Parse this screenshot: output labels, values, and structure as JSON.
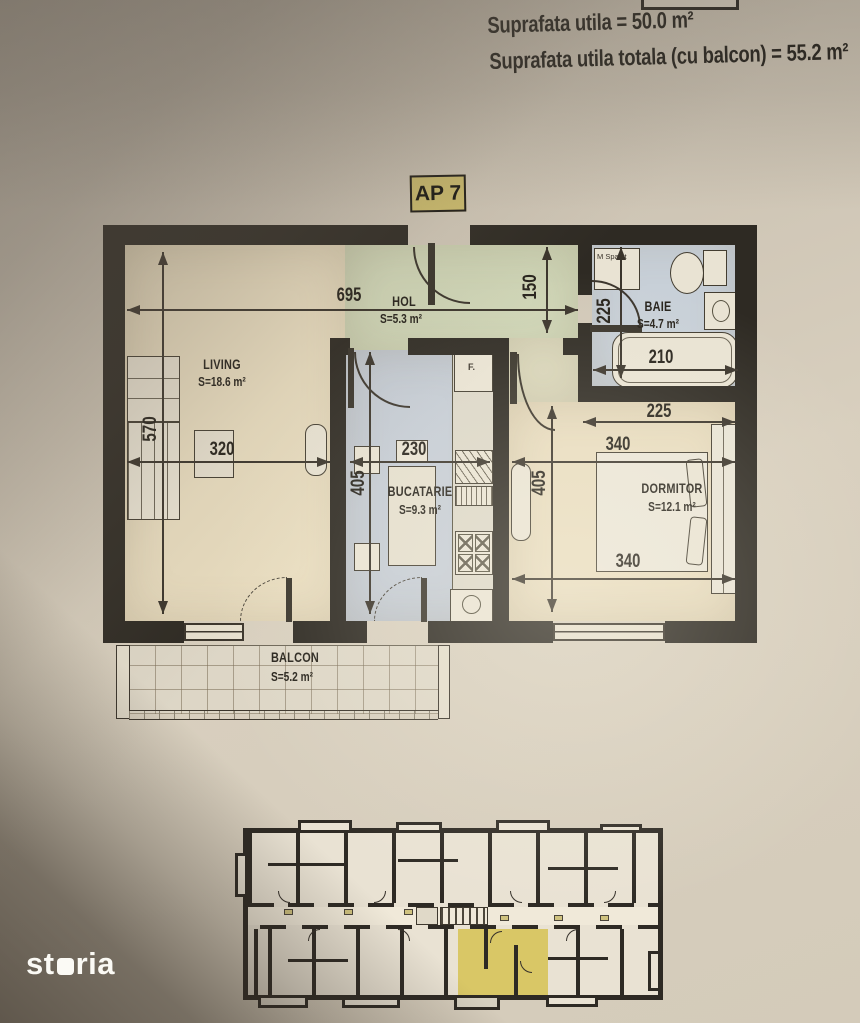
{
  "header": {
    "line1": "Suprafata utila = 50.0 m²",
    "line2": "Suprafata utila totala (cu balcon) = 55.2 m²"
  },
  "apartment": {
    "label": "AP 7"
  },
  "rooms": {
    "living": {
      "name": "LIVING",
      "area": "S=18.6 m²"
    },
    "hol": {
      "name": "HOL",
      "area": "S=5.3 m²"
    },
    "baie": {
      "name": "BAIE",
      "area": "S=4.7 m²"
    },
    "bucatarie": {
      "name": "BUCATARIE",
      "area": "S=9.3 m²"
    },
    "dormitor": {
      "name": "DORMITOR",
      "area": "S=12.1 m²"
    },
    "balcon": {
      "name": "BALCON",
      "area": "S=5.2 m²"
    }
  },
  "fixtures": {
    "washing_machine": "M Spalat",
    "fridge": "F."
  },
  "dimensions": {
    "hol_width": "695",
    "hol_depth": "150",
    "living_width": "320",
    "living_height": "570",
    "kitchen_width": "230",
    "kitchen_height": "405",
    "baie_depth": "225",
    "bathtub_width": "210",
    "dormitor_upper_width": "225",
    "dormitor_width_top": "340",
    "dormitor_height": "405",
    "dormitor_width_bottom": "340"
  },
  "watermark": {
    "pre": "st",
    "post": "ria"
  },
  "colors": {
    "badge_bg": "#c9b96b",
    "highlight_unit": "#d9c766",
    "hol_fill": "#cfd5b6",
    "bath_fill": "#c8d0d8",
    "kitchen_fill": "#c5ccd5",
    "warm_room_fill": "#e8dcbf"
  }
}
